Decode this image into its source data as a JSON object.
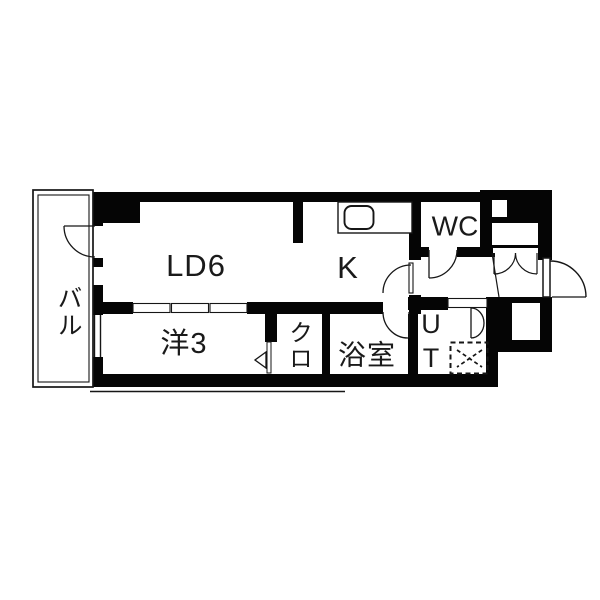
{
  "floor_plan": {
    "title": "apartment-floor-plan-1k",
    "rooms": [
      {
        "id": "balcony",
        "label": "バル"
      },
      {
        "id": "living-dining",
        "label": "LD6"
      },
      {
        "id": "kitchen",
        "label": "K"
      },
      {
        "id": "toilet",
        "label": "WC"
      },
      {
        "id": "western-room",
        "label": "洋3"
      },
      {
        "id": "closet",
        "label": "クロ"
      },
      {
        "id": "bathroom",
        "label": "浴室"
      },
      {
        "id": "utility",
        "label": "UT"
      }
    ],
    "fixtures": [
      {
        "id": "kitchen-sink"
      },
      {
        "id": "washing-machine-pan"
      },
      {
        "id": "entrance-door"
      },
      {
        "id": "shoe-closet-double-doors"
      },
      {
        "id": "pipe-space"
      },
      {
        "id": "pipe-space-lower"
      }
    ],
    "colors": {
      "wall": "#050505",
      "line": "#161616",
      "background": "#ffffff"
    }
  }
}
